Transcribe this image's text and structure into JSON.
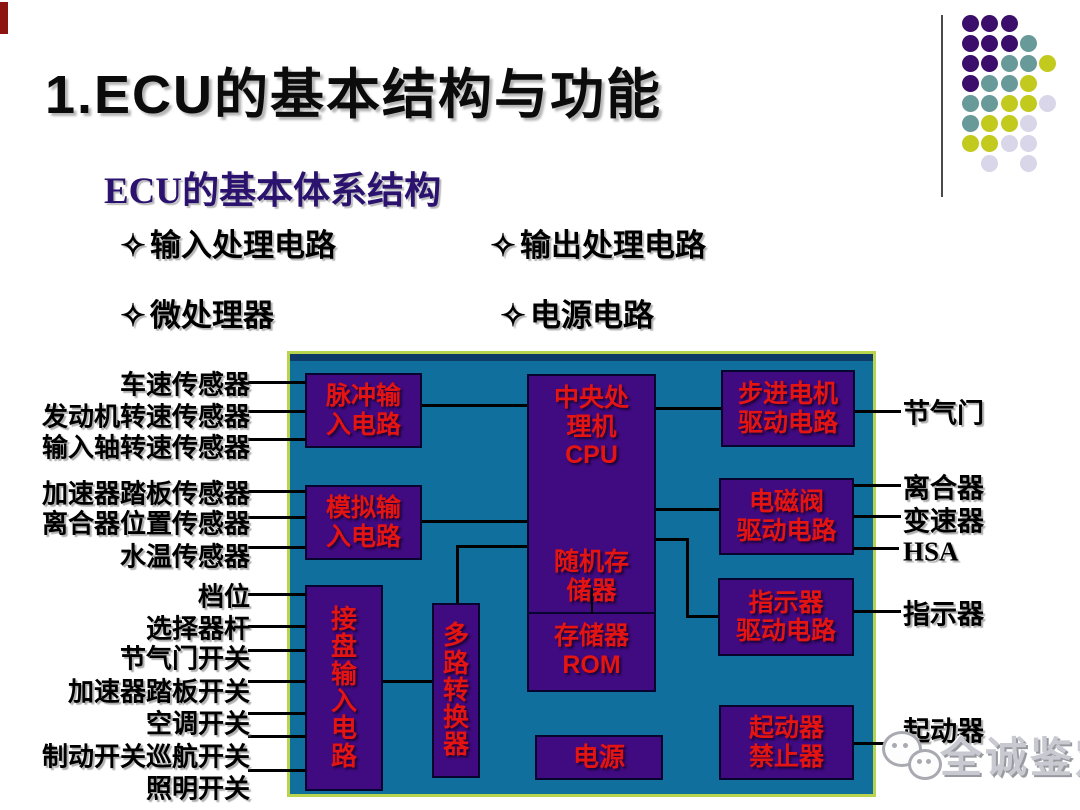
{
  "slide": {
    "title": "1.ECU的基本结构与功能",
    "subtitle": "ECU的基本体系结构",
    "bullets": [
      {
        "marker": "✧",
        "label": "输入处理电路",
        "x": 120,
        "y": 220
      },
      {
        "marker": "✧",
        "label": "输出处理电路",
        "x": 490,
        "y": 220
      },
      {
        "marker": "✧",
        "label": "微处理器",
        "x": 120,
        "y": 290
      },
      {
        "marker": "✧",
        "label": "电源电路",
        "x": 500,
        "y": 290
      }
    ]
  },
  "colors": {
    "diagram_background": "#116f9e",
    "diagram_border": "#b8d44e",
    "block_fill": "#400a80",
    "block_border": "#07052e",
    "block_text": "#e31412",
    "line": "#000000",
    "subtitle_text": "#2a126e"
  },
  "decor": {
    "dots": {
      "origin_x": 962,
      "origin_y": 15,
      "dx": 19.3,
      "dy": 20,
      "size": 17,
      "palette": {
        "P": "#3c0e6b",
        "T": "#679a99",
        "Y": "#c3ca1e",
        "L": "#d8d6e8"
      },
      "rows": [
        [
          [
            0,
            "P"
          ],
          [
            1,
            "P"
          ],
          [
            2,
            "P"
          ]
        ],
        [
          [
            0,
            "P"
          ],
          [
            1,
            "P"
          ],
          [
            2,
            "P"
          ],
          [
            3,
            "T"
          ]
        ],
        [
          [
            0,
            "P"
          ],
          [
            1,
            "P"
          ],
          [
            2,
            "T"
          ],
          [
            3,
            "T"
          ],
          [
            4,
            "Y"
          ]
        ],
        [
          [
            0,
            "P"
          ],
          [
            1,
            "T"
          ],
          [
            2,
            "T"
          ],
          [
            3,
            "Y"
          ]
        ],
        [
          [
            0,
            "T"
          ],
          [
            1,
            "T"
          ],
          [
            2,
            "Y"
          ],
          [
            3,
            "Y"
          ],
          [
            4,
            "L"
          ]
        ],
        [
          [
            0,
            "T"
          ],
          [
            1,
            "Y"
          ],
          [
            2,
            "Y"
          ],
          [
            3,
            "L"
          ]
        ],
        [
          [
            0,
            "Y"
          ],
          [
            1,
            "Y"
          ],
          [
            2,
            "L"
          ],
          [
            3,
            "L"
          ]
        ],
        [
          [
            1,
            "L"
          ],
          [
            3,
            "L"
          ]
        ]
      ]
    }
  },
  "diagram": {
    "frame": {
      "x": 287,
      "y": 351,
      "w": 589,
      "h": 446
    },
    "blocks": [
      {
        "id": "pulse-input-circuit",
        "lines": [
          "脉冲输",
          "入电路"
        ],
        "x": 305,
        "y": 373,
        "w": 117,
        "h": 75
      },
      {
        "id": "analog-input-circuit",
        "lines": [
          "模拟输",
          "入电路"
        ],
        "x": 305,
        "y": 485,
        "w": 117,
        "h": 75
      },
      {
        "id": "keypad-input-circuit",
        "lines": [
          "接",
          "盘",
          "输",
          "入",
          "电",
          "路"
        ],
        "x": 305,
        "y": 585,
        "w": 78,
        "h": 206,
        "vertical": true
      },
      {
        "id": "multiplexer",
        "lines": [
          "多",
          "路",
          "转",
          "换",
          "器"
        ],
        "x": 432,
        "y": 603,
        "w": 48,
        "h": 175,
        "vertical": true
      },
      {
        "id": "power-supply",
        "lines": [
          "电源"
        ],
        "x": 535,
        "y": 735,
        "w": 128,
        "h": 45,
        "font": 26
      },
      {
        "id": "stepper-motor-driver",
        "lines": [
          "步进电机",
          "驱动电路"
        ],
        "x": 721,
        "y": 370,
        "w": 134,
        "h": 77
      },
      {
        "id": "solenoid-valve-driver",
        "lines": [
          "电磁阀",
          "驱动电路"
        ],
        "x": 719,
        "y": 478,
        "w": 135,
        "h": 77
      },
      {
        "id": "indicator-driver",
        "lines": [
          "指示器",
          "驱动电路"
        ],
        "x": 718,
        "y": 578,
        "w": 136,
        "h": 78
      },
      {
        "id": "starter-inhibitor",
        "lines": [
          "起动器",
          "禁止器"
        ],
        "x": 719,
        "y": 705,
        "w": 135,
        "h": 75
      }
    ],
    "cpu_block": {
      "id": "cpu-memory",
      "x": 527,
      "y": 374,
      "w": 129,
      "h": 318,
      "divider_y": 236,
      "sections": [
        {
          "name": "cpu-section",
          "top": 8,
          "lines": [
            "中央处",
            "理机",
            "CPU"
          ]
        },
        {
          "name": "ram-section",
          "top": 172,
          "lines": [
            "随机存",
            "储器"
          ]
        },
        {
          "name": "rom-section",
          "top": 246,
          "lines": [
            "存储器",
            "ROM"
          ]
        }
      ]
    },
    "connectors": [
      {
        "x": 422,
        "y": 404,
        "w": 105,
        "h": 3
      },
      {
        "x": 422,
        "y": 520,
        "w": 105,
        "h": 3
      },
      {
        "x": 456,
        "y": 545,
        "w": 71,
        "h": 3
      },
      {
        "x": 456,
        "y": 545,
        "w": 3,
        "h": 58
      },
      {
        "x": 383,
        "y": 680,
        "w": 49,
        "h": 3
      },
      {
        "x": 656,
        "y": 407,
        "w": 65,
        "h": 3
      },
      {
        "x": 656,
        "y": 508,
        "w": 63,
        "h": 3
      },
      {
        "x": 656,
        "y": 538,
        "w": 33,
        "h": 3
      },
      {
        "x": 686,
        "y": 538,
        "w": 3,
        "h": 80
      },
      {
        "x": 686,
        "y": 615,
        "w": 32,
        "h": 3
      },
      {
        "x": 591,
        "y": 588,
        "w": 2,
        "h": 26
      },
      {
        "x": 248,
        "y": 381,
        "w": 58,
        "h": 3
      },
      {
        "x": 248,
        "y": 410,
        "w": 58,
        "h": 3
      },
      {
        "x": 248,
        "y": 438,
        "w": 58,
        "h": 3
      },
      {
        "x": 248,
        "y": 490,
        "w": 58,
        "h": 3
      },
      {
        "x": 248,
        "y": 516,
        "w": 58,
        "h": 3
      },
      {
        "x": 248,
        "y": 546,
        "w": 58,
        "h": 3
      },
      {
        "x": 248,
        "y": 593,
        "w": 58,
        "h": 3
      },
      {
        "x": 248,
        "y": 625,
        "w": 58,
        "h": 3
      },
      {
        "x": 248,
        "y": 649,
        "w": 58,
        "h": 3
      },
      {
        "x": 248,
        "y": 680,
        "w": 58,
        "h": 3
      },
      {
        "x": 248,
        "y": 712,
        "w": 58,
        "h": 3
      },
      {
        "x": 248,
        "y": 735,
        "w": 58,
        "h": 3
      },
      {
        "x": 248,
        "y": 769,
        "w": 58,
        "h": 3
      },
      {
        "x": 855,
        "y": 410,
        "w": 46,
        "h": 3
      },
      {
        "x": 854,
        "y": 484,
        "w": 47,
        "h": 3
      },
      {
        "x": 854,
        "y": 515,
        "w": 47,
        "h": 3
      },
      {
        "x": 854,
        "y": 547,
        "w": 45,
        "h": 3
      },
      {
        "x": 854,
        "y": 610,
        "w": 47,
        "h": 3
      },
      {
        "x": 854,
        "y": 742,
        "w": 52,
        "h": 3
      }
    ],
    "left_labels": [
      {
        "text": "车速传感器",
        "y": 383
      },
      {
        "text": "发动机转速传感器",
        "y": 415
      },
      {
        "text": "输入轴转速传感器",
        "y": 446
      },
      {
        "text": "加速器踏板传感器",
        "y": 492
      },
      {
        "text": "离合器位置传感器",
        "y": 522
      },
      {
        "text": "水温传感器",
        "y": 555
      },
      {
        "text": "档位",
        "y": 595
      },
      {
        "text": "选择器杆",
        "y": 627
      },
      {
        "text": "节气门开关",
        "y": 657
      },
      {
        "text": "加速器踏板开关",
        "y": 690
      },
      {
        "text": "空调开关",
        "y": 722
      },
      {
        "text": "制动开关巡航开关",
        "y": 755
      },
      {
        "text": "照明开关",
        "y": 787
      }
    ],
    "right_labels": [
      {
        "text": "节气门",
        "y": 411
      },
      {
        "text": "离合器",
        "y": 486
      },
      {
        "text": "变速器",
        "y": 519
      },
      {
        "text": "HSA",
        "y": 552,
        "serif": true
      },
      {
        "text": "指示器",
        "y": 612
      },
      {
        "text": "起动器",
        "y": 729
      }
    ]
  },
  "watermark": {
    "text": "全诚鉴定",
    "icon": "chat-bubbles-icon"
  }
}
